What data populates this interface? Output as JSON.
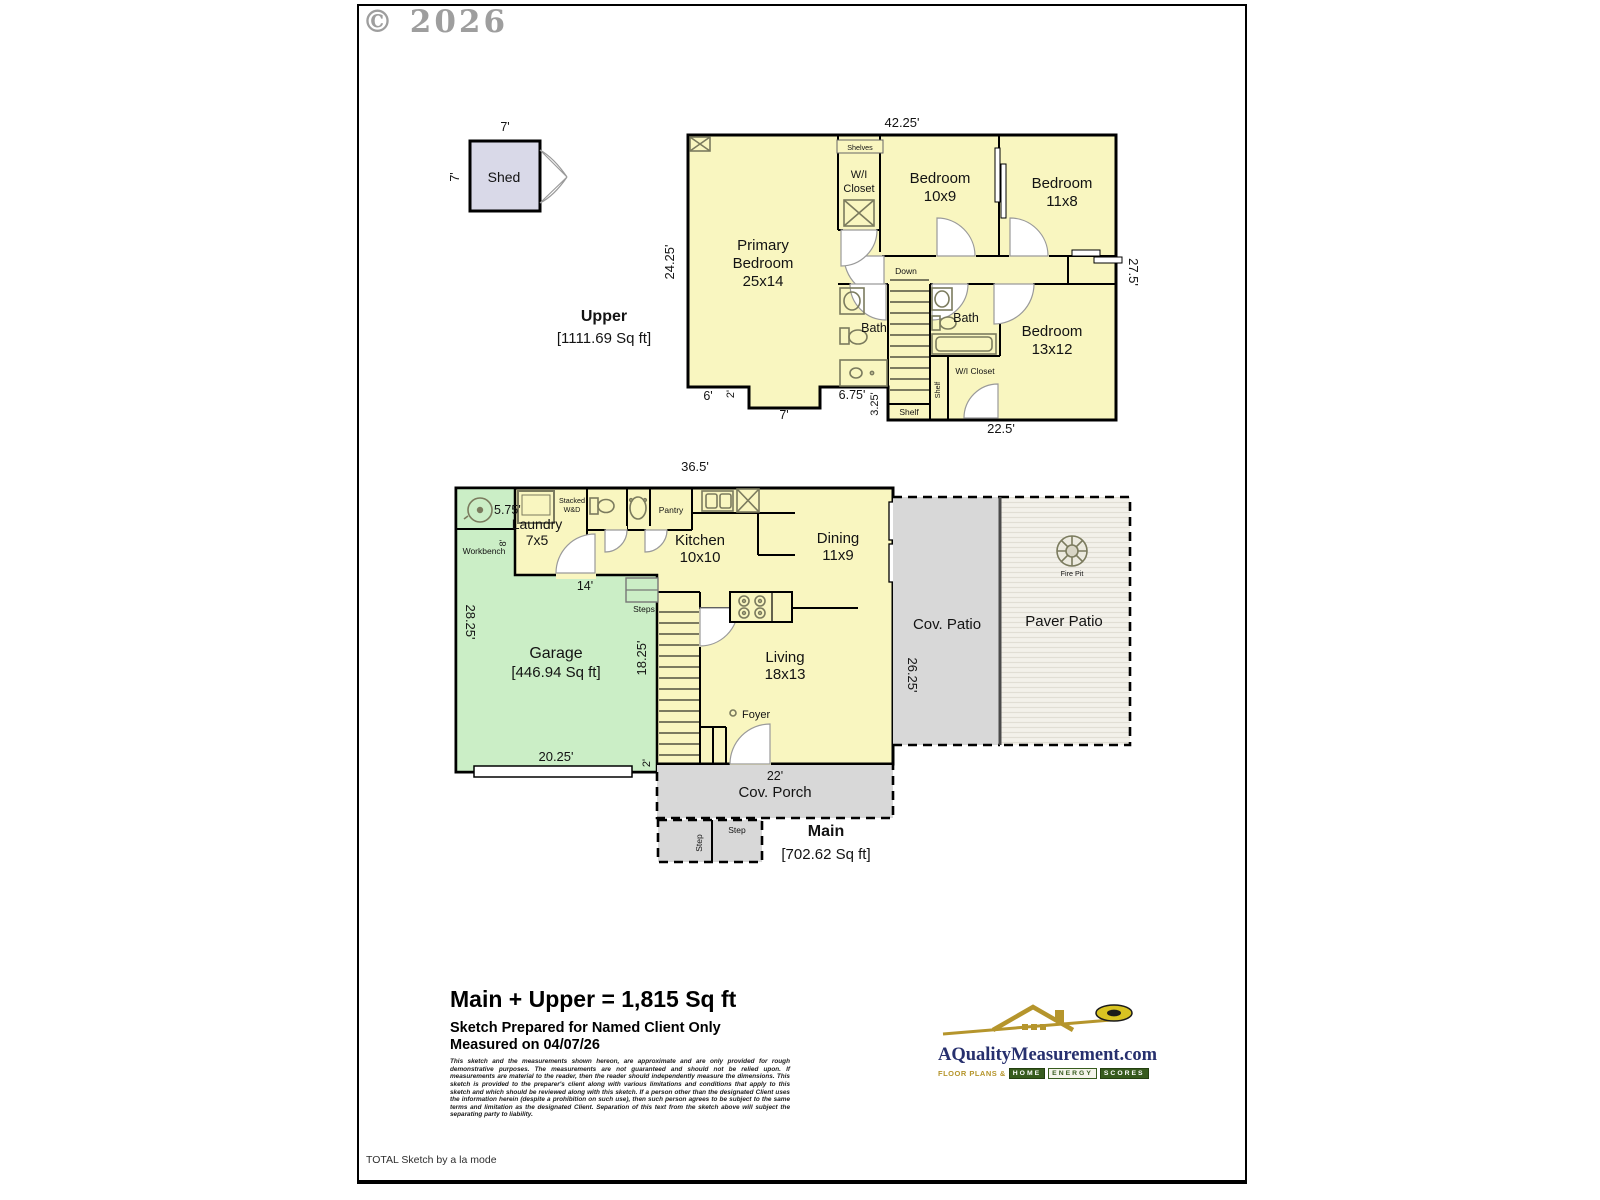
{
  "page": {
    "copyright": "© 2026",
    "footer_note": "TOTAL Sketch by a la mode"
  },
  "shed": {
    "label": "Shed",
    "dim_top": "7'",
    "dim_side": "7'"
  },
  "upper": {
    "title": "Upper",
    "area": "[1111.69 Sq ft]",
    "dim_top": "42.25'",
    "dim_left": "24.25'",
    "dim_right": "27.5'",
    "dim_b1": "6'",
    "dim_b2": "2'",
    "dim_b3": "7'",
    "dim_b4": "6.75'",
    "dim_b5": "3.25'",
    "dim_b6": "22.5'",
    "primary1": "Primary",
    "primary2": "Bedroom",
    "primary3": "25x14",
    "bed2a": "Bedroom",
    "bed2b": "10x9",
    "bed3a": "Bedroom",
    "bed3b": "11x8",
    "bed4a": "Bedroom",
    "bed4b": "13x12",
    "wic1a": "W/I",
    "wic1b": "Closet",
    "shelves": "Shelves",
    "down": "Down",
    "bath1": "Bath",
    "bath2": "Bath",
    "wic2": "W/I Closet",
    "shelf1": "Shelf",
    "shelf2": "Shelf"
  },
  "main": {
    "title": "Main",
    "area": "[702.62 Sq ft]",
    "dim_top": "36.5'",
    "dim_wh": "5.75'",
    "dim_wb": "8'",
    "workbench": "Workbench",
    "stacked1": "Stacked",
    "stacked2": "W&D",
    "laundry1": "Laundry",
    "laundry2": "7x5",
    "pantry": "Pantry",
    "kitchen1": "Kitchen",
    "kitchen2": "10x10",
    "dining1": "Dining",
    "dining2": "11x9",
    "garage1": "Garage",
    "garage2": "[446.94 Sq ft]",
    "dim_left": "28.25'",
    "dim_14": "14'",
    "dim_stairs": "18.25'",
    "dim_bottom": "20.25'",
    "dim_2": "2'",
    "steps": "Steps",
    "living1": "Living",
    "living2": "18x13",
    "foyer": "Foyer",
    "dim_porch": "22'",
    "porch": "Cov. Porch",
    "step1": "Step",
    "step2": "Step",
    "patio": "Cov. Patio",
    "dim_patio": "26.25'",
    "paver": "Paver Patio",
    "firepit": "Fire Pit"
  },
  "summary": {
    "total": "Main + Upper = 1,815 Sq ft",
    "prepared": "Sketch Prepared for Named Client Only",
    "measured": "Measured on 04/07/26",
    "disclaimer": "This sketch and the measurements shown hereon, are approximate and are only provided for rough demonstrative purposes. The measurements are not guaranteed and should not be relied upon. If measurements are material to the reader, then the reader should independently measure the dimensions. This sketch is provided to the preparer's client along with various limitations and conditions that apply to this sketch and which should be reviewed along with this sketch. If a person other than the designated Client uses the information herein (despite a prohibition on such use), then such person agrees to be subject to the same terms and limitation as the designated Client. Separation of this text from the sketch above will subject the separating party to liability."
  },
  "logo": {
    "brand": "AQualityMeasurement.com",
    "tagline": "Floor Plans &",
    "t1": "HOME",
    "t2": "ENERGY",
    "t3": "SCORES"
  },
  "colors": {
    "room_yellow": "#F9F6C0",
    "garage_green": "#CBEEC6",
    "patio_gray": "#D8D8D8",
    "shed_lavender": "#D9D9E8",
    "logo_navy": "#27306E",
    "logo_gold": "#B5952C",
    "tile_green": "#375B1E"
  }
}
